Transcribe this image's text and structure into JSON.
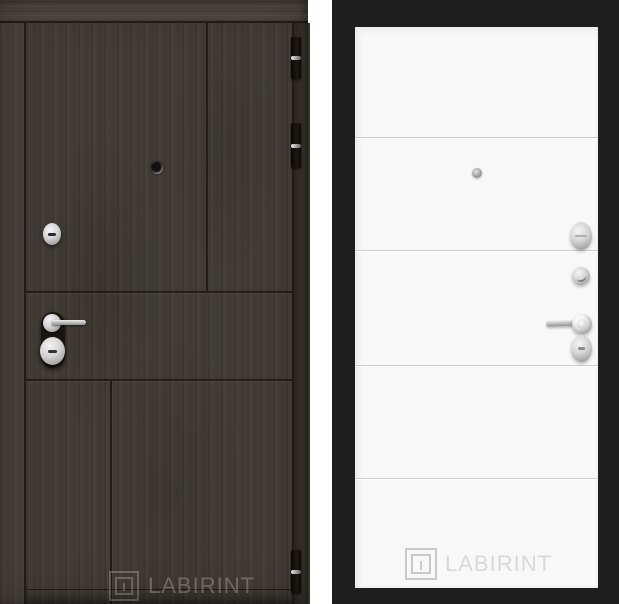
{
  "page": {
    "background_color": "#ffffff",
    "description": "product image of two steel door panels side by side"
  },
  "left_door": {
    "side": "exterior panel, dark wenge wood finish",
    "watermark": {
      "brand": "LABIRINT"
    },
    "hardware": [
      "peephole",
      "keyhole-escutcheon",
      "lever-handle",
      "cylinder-escutcheon",
      "hinge",
      "hinge",
      "hinge"
    ],
    "colors": {
      "wood_base": "#46413b",
      "wood_frame": "#4e4841",
      "panel_seam": "#221d18",
      "hinge": "#17120d",
      "hardware_silver": "#c9c9c9",
      "watermark": "rgba(228,222,214,0.32)"
    }
  },
  "right_door": {
    "side": "interior panel, white with horizontal grooves, black frame",
    "watermark": {
      "brand": "LABIRINT"
    },
    "hardware": [
      "peephole",
      "viewer-cover",
      "thumb-turn-lock",
      "lever-handle",
      "keyhole-escutcheon"
    ],
    "colors": {
      "frame": "#1e1e1e",
      "panel": "#f8f8f8",
      "groove_line": "#cccccc",
      "hardware_silver": "#c9c9c9",
      "watermark": "#d8d8d8"
    }
  }
}
